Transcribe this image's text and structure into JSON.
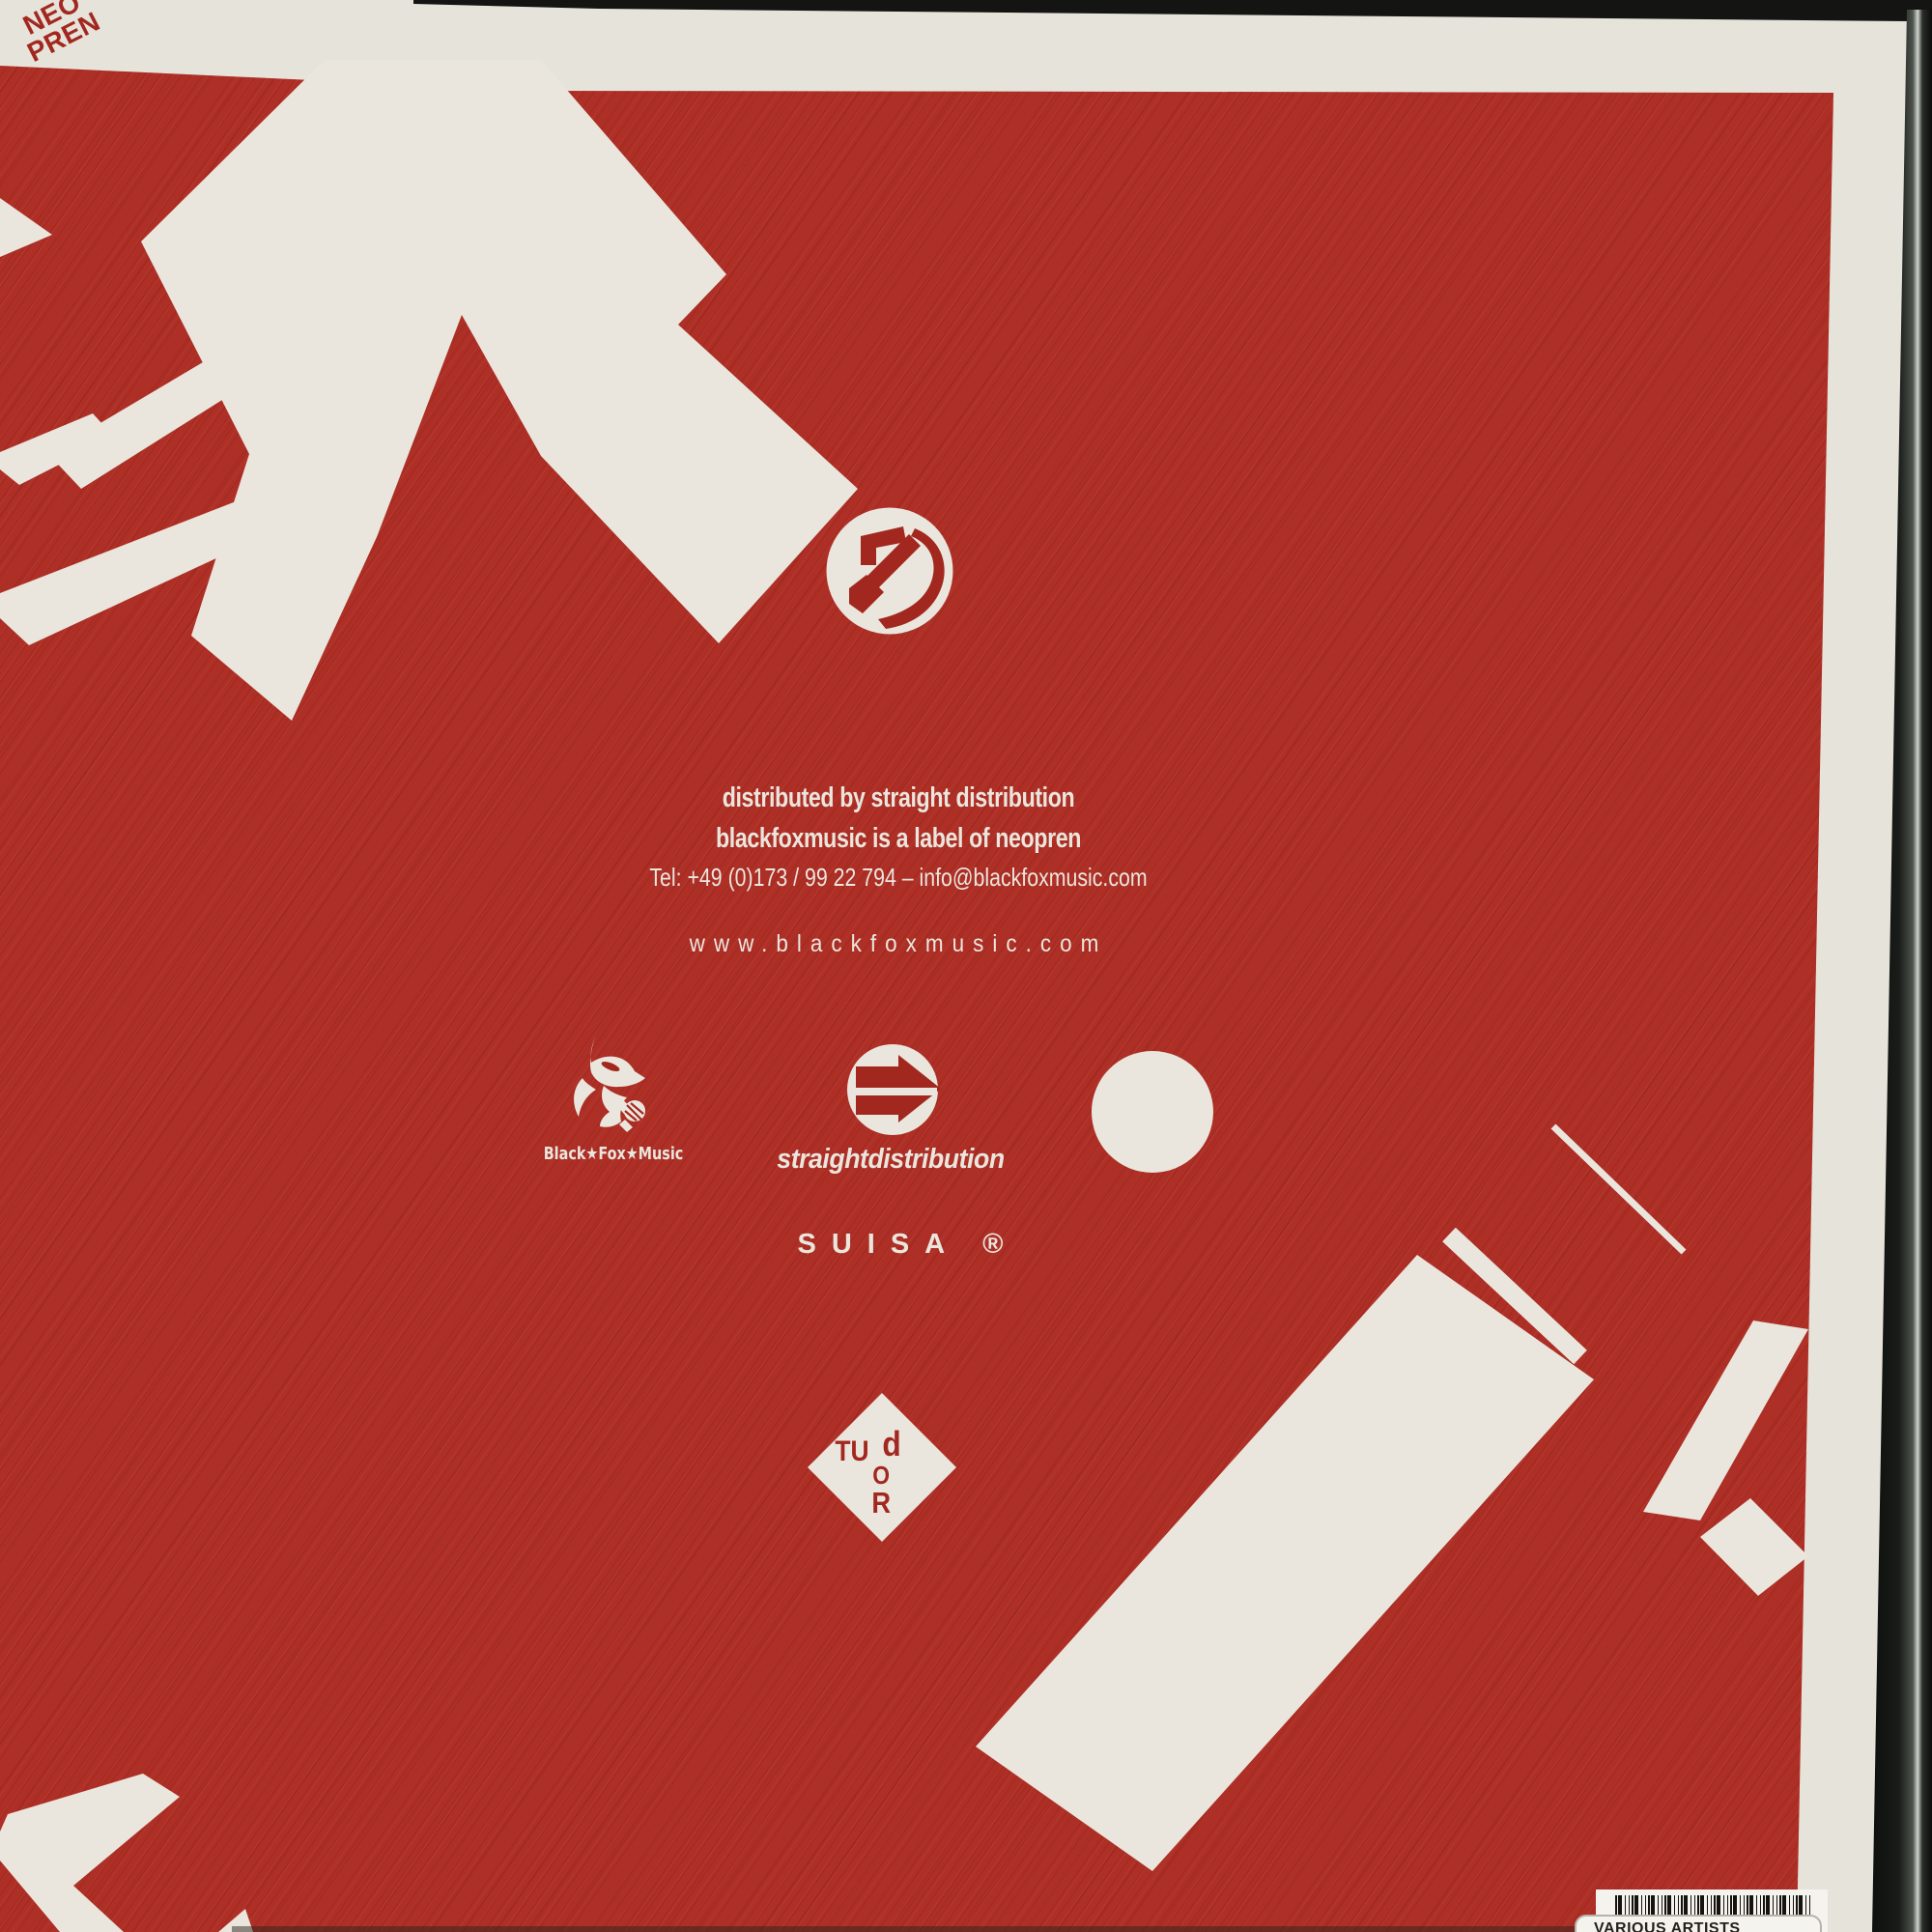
{
  "colors": {
    "red": "#ae2f26",
    "red_deep": "#a2281f",
    "cream": "#eae6dd",
    "margin": "#e6e3da",
    "frame": "#1b1d1a",
    "bar_black": "#141512",
    "label_bg": "#f4f3ee",
    "label_border": "#b7b3aa",
    "ink": "#24211d"
  },
  "center_mark": {
    "icon": "hammer-sickle-monogram"
  },
  "contact": {
    "line1": "distributed by straight distribution",
    "line2": "blackfoxmusic is a label of neopren",
    "line3": "Tel: +49 (0)173 / 99 22 794 – info@blackfoxmusic.com",
    "website": "www.blackfoxmusic.com"
  },
  "logos": {
    "black_fox_music": {
      "label": "Black★Fox★Music"
    },
    "straight_distribution": {
      "wordmark": "straightdistribution"
    },
    "neopren": {
      "line1": "NEO",
      "line2": "PREN"
    },
    "tudor": {
      "t": "TU",
      "d": "d",
      "o": "O",
      "r": "R"
    }
  },
  "rights": {
    "label": "SUISA ®"
  },
  "sticker": {
    "artist": "VARIOUS ARTISTS"
  }
}
